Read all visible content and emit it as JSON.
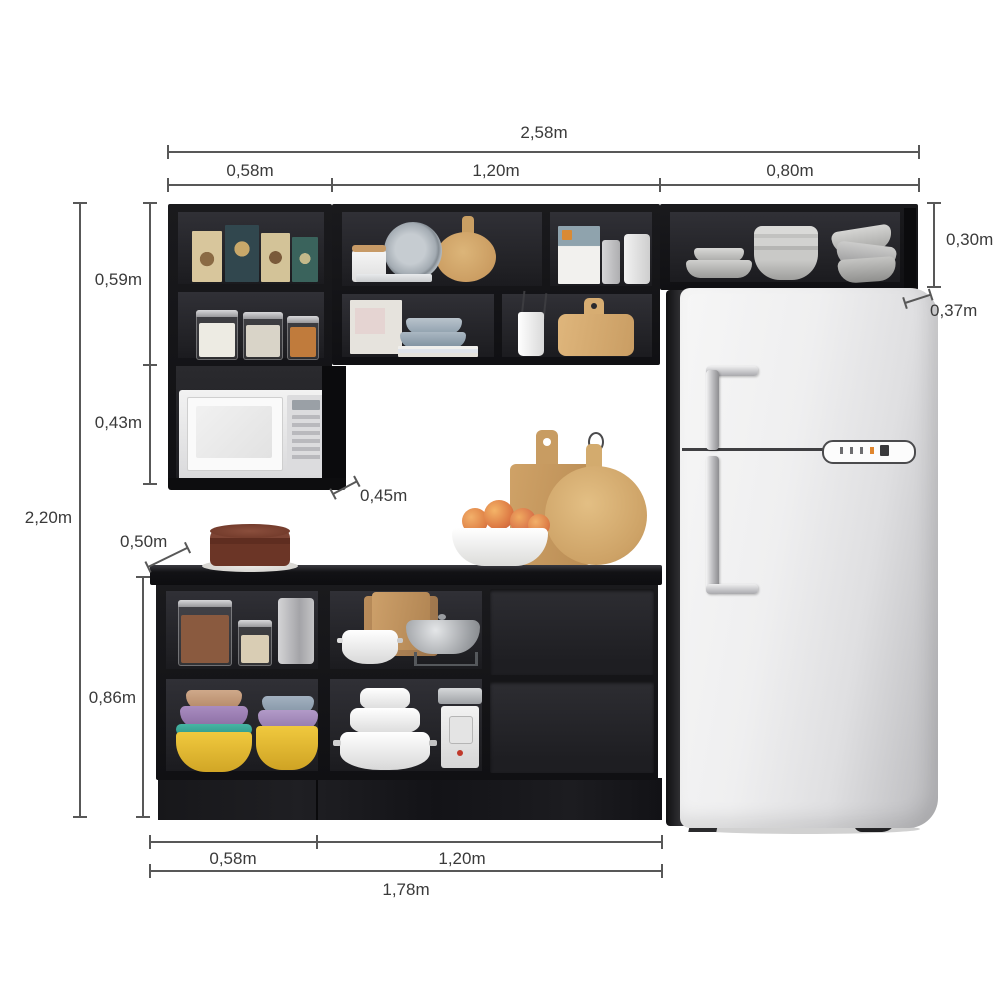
{
  "diagram": {
    "product": "Kitchen cabinet set with refrigerator - dimension diagram",
    "dimensions": {
      "total_width": "2,58m",
      "top_segment_left": "0,58m",
      "top_segment_middle": "1,20m",
      "top_segment_right": "0,80m",
      "upper_right_cabinet_height": "0,30m",
      "upper_right_cabinet_depth": "0,37m",
      "upper_left_top_section_height": "0,59m",
      "upper_left_bottom_section_height": "0,43m",
      "total_height": "2,20m",
      "upper_cabinet_depth": "0,45m",
      "countertop_depth": "0,50m",
      "base_cabinet_height": "0,86m",
      "base_segment_left": "0,58m",
      "base_segment_right": "1,20m",
      "base_total_width": "1,78m"
    }
  }
}
